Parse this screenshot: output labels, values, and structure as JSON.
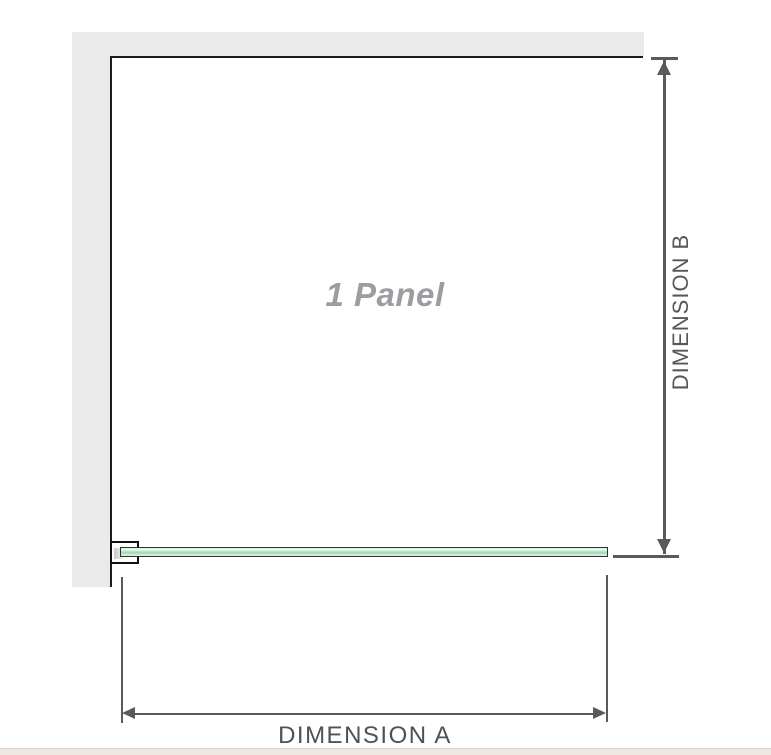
{
  "diagram": {
    "title": "shower screen single panel dimension diagram",
    "panel_label": "1 Panel",
    "dimension_a_label": "DIMENSION A",
    "dimension_b_label": "DIMENSION B",
    "colors": {
      "wall_gray": "#eaeaea",
      "panel_border": "#1c1c1c",
      "dimension_line": "#595a5c",
      "dimension_text": "#55575a",
      "panel_text": "#9b9da0",
      "glass_green_light": "#dff2e6",
      "glass_green_mid": "#9fd8b6",
      "glass_outline": "#24382c",
      "bottom_strip": "#ece7e2"
    }
  }
}
